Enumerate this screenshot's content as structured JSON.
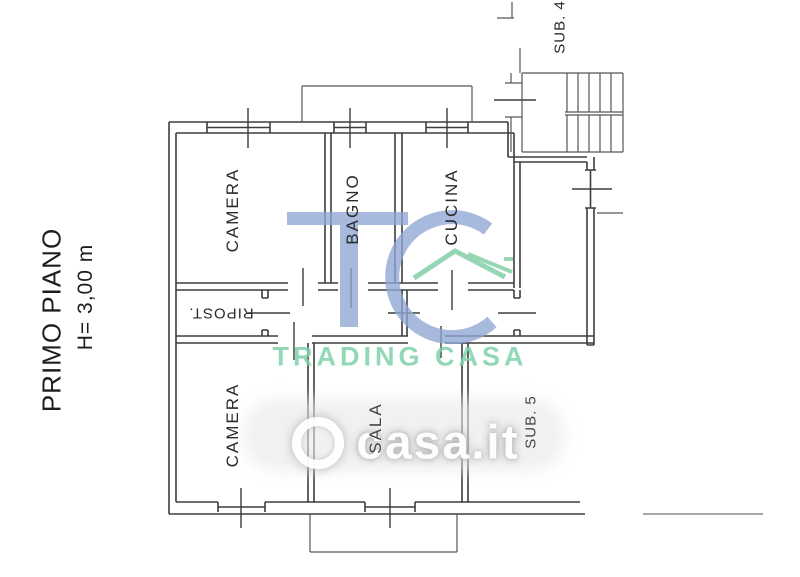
{
  "side_labels": {
    "floor": "PRIMO PIANO",
    "height": "H= 3,00 m"
  },
  "rooms": {
    "camera_top": "CAMERA",
    "bagno": "BAGNO",
    "cucina": "CUCINA",
    "ripost": "RIPOST.",
    "camera_bottom": "CAMERA",
    "sala": "SALA",
    "sub5": "SUB. 5",
    "sub4": "SUB. 4"
  },
  "watermarks": {
    "tc_text": "TC",
    "trading_casa": "TRADING CASA",
    "casa_it": "casa.it",
    "blue": "#8fa7d6",
    "green": "#84cfa8"
  },
  "plan": {
    "line_color": "#3d3d3d"
  }
}
